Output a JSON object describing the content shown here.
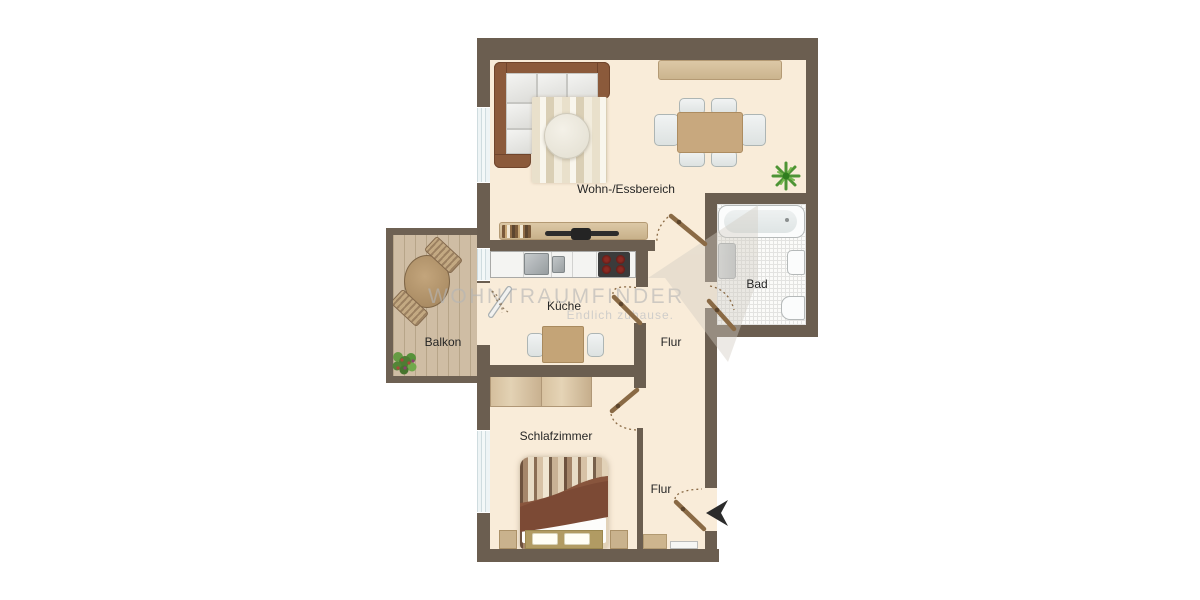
{
  "plan": {
    "type": "apartment-floor-plan",
    "rooms": [
      {
        "id": "wohn-essbereich",
        "label": "Wohn-/Essbereich"
      },
      {
        "id": "kueche",
        "label": "Küche"
      },
      {
        "id": "bad",
        "label": "Bad"
      },
      {
        "id": "flur-oben",
        "label": "Flur"
      },
      {
        "id": "balkon",
        "label": "Balkon"
      },
      {
        "id": "schlafzimmer",
        "label": "Schlafzimmer"
      },
      {
        "id": "flur-unten",
        "label": "Flur"
      }
    ],
    "furniture": [
      "corner-sofa",
      "rug",
      "coffee-table",
      "tv-bench",
      "tv",
      "sideboard",
      "dining-table",
      "dining-chairs",
      "plant",
      "kitchen-counter",
      "sink",
      "stove",
      "kitchen-table",
      "kitchen-chairs",
      "bathtub",
      "washing-machine",
      "bath-sink",
      "toilet",
      "wardrobe",
      "double-bed",
      "nightstands",
      "balcony-table",
      "balcony-chairs",
      "balcony-plant",
      "hall-cabinet",
      "doormat"
    ]
  },
  "watermark": {
    "brand": "WOHNTRAUMFINDER",
    "tagline": "Endlich zuhause."
  },
  "colors": {
    "wall": "#6b5e50",
    "floor": "#f9ecd9",
    "balcony_floor": "#cfbda4",
    "wood": "#c9a97d",
    "door": "#8a6a45",
    "sofa": "#8b5a3b",
    "bed_blanket": "#7c4a35",
    "tile_line": "#e3e3e1",
    "entrance_arrow": "#2b2b2b",
    "watermark_gray": "#b5b5b5"
  }
}
